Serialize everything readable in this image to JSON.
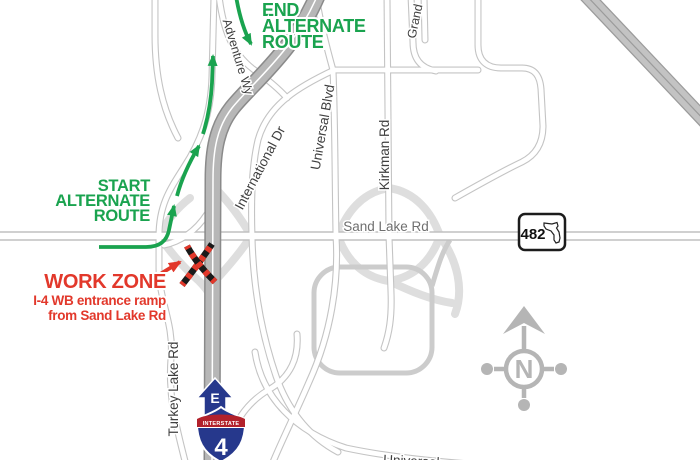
{
  "route_guidance": {
    "start": {
      "lines": [
        "START",
        "ALTERNATE",
        "ROUTE"
      ]
    },
    "end": {
      "lines": [
        "END",
        "ALTERNATE",
        "ROUTE"
      ]
    }
  },
  "work_zone": {
    "title": "WORK ZONE",
    "detail_line1": "I-4 WB entrance ramp",
    "detail_line2": "from Sand Lake Rd"
  },
  "roads": {
    "sand_lake": "Sand Lake Rd",
    "international": "International Dr",
    "universal": "Universal Blvd",
    "kirkman": "Kirkman Rd",
    "grand": "Grand",
    "adventure": "Adventure Wy",
    "turkey_lake": "Turkey Lake Rd",
    "universal_bottom": "Universal"
  },
  "shields": {
    "state_route_number": "482",
    "interstate_number": "4",
    "interstate_text": "INTERSTATE",
    "direction_marker": "E"
  },
  "compass": {
    "label": "N"
  },
  "colors": {
    "route_green": "#1aa34f",
    "alert_red": "#e2382b",
    "interstate_gray": "#b7b7b7",
    "shield_blue": "#26388c",
    "shield_band_red": "#b2212b"
  }
}
